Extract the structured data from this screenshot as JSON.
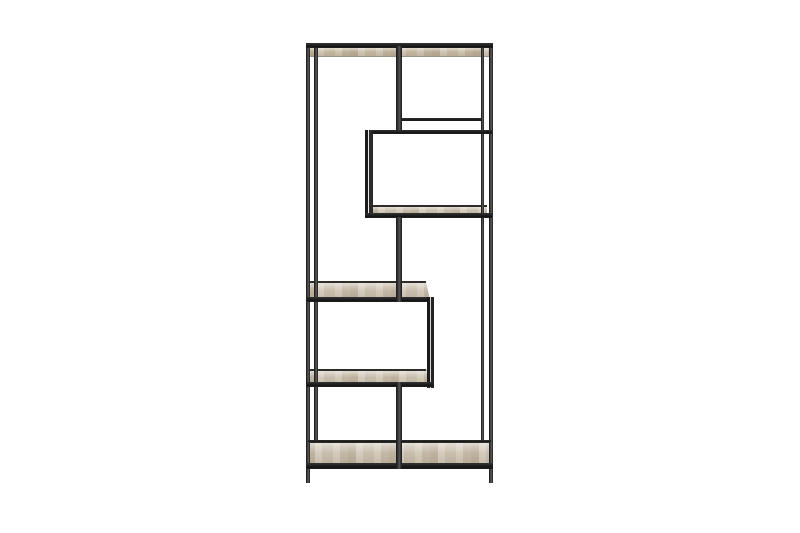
{
  "image": {
    "kind": "product-photo",
    "subject": "Tall open etagere bookcase with a thin black metal frame and five light sonoma-oak shelves arranged in a staggered asymmetric pattern, photographed on a plain white studio background",
    "alt": "Black metal frame bookcase with asymmetric oak shelves"
  },
  "colors": {
    "background": "#ffffff",
    "metal_dark": "#1a1a1a",
    "wood_base": "#cdc3b2",
    "wood_underside": "#c9bca6",
    "back_rail_line": "#2e2c29",
    "wood_edge_line": "#97948c"
  },
  "parts": {
    "frame": "black powder-coated metal frame",
    "top_shelf": "full-width oak top shelf",
    "upper_right_box": "suspended shelf compartment on right side",
    "middle_left_shelf": "oak shelf spanning left two-thirds",
    "lower_left_shelf": "oak shelf spanning left two-thirds",
    "bottom_shelf": "full-width oak bottom shelf",
    "legs": "four slender square-tube legs"
  }
}
